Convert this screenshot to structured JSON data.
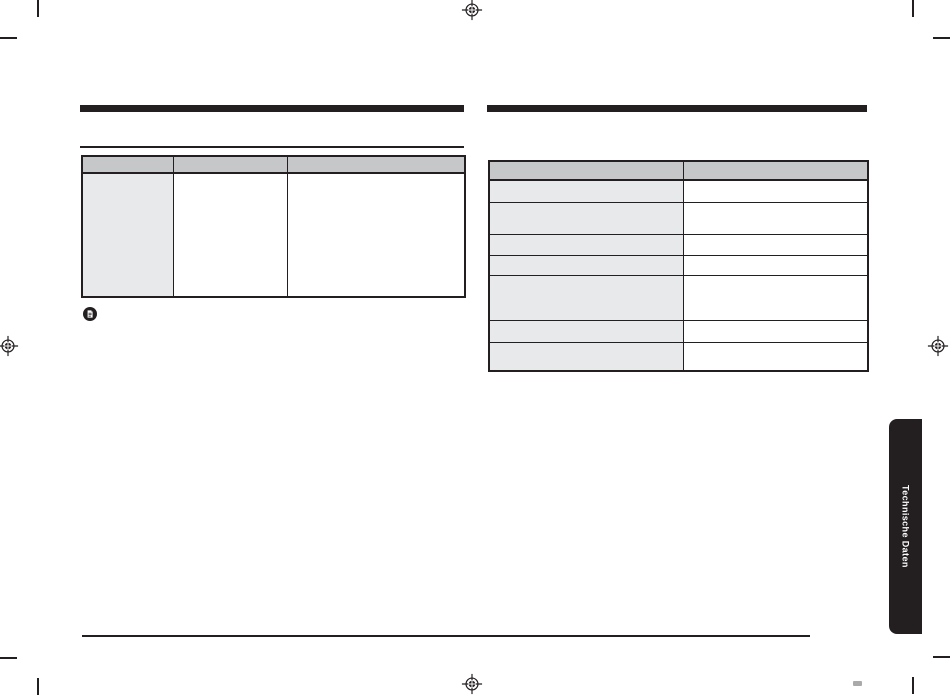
{
  "document": {
    "side_tab": {
      "label": "Technische Daten"
    },
    "left_section": {
      "table": {
        "header": [
          "",
          "",
          ""
        ],
        "rows": [
          [
            "",
            "",
            ""
          ]
        ]
      }
    },
    "right_section": {
      "table": {
        "header": [
          "",
          ""
        ],
        "rows": [
          [
            "",
            ""
          ],
          [
            "",
            ""
          ],
          [
            "",
            ""
          ],
          [
            "",
            ""
          ],
          [
            "",
            ""
          ],
          [
            "",
            ""
          ],
          [
            "",
            ""
          ]
        ]
      }
    },
    "colors": {
      "print_black": "#231f20",
      "table_header_bg": "#c6c7c8",
      "table_shaded_col_bg": "#e8e9ea",
      "tab_text": "#ffffff",
      "page_bg": "#ffffff"
    }
  }
}
